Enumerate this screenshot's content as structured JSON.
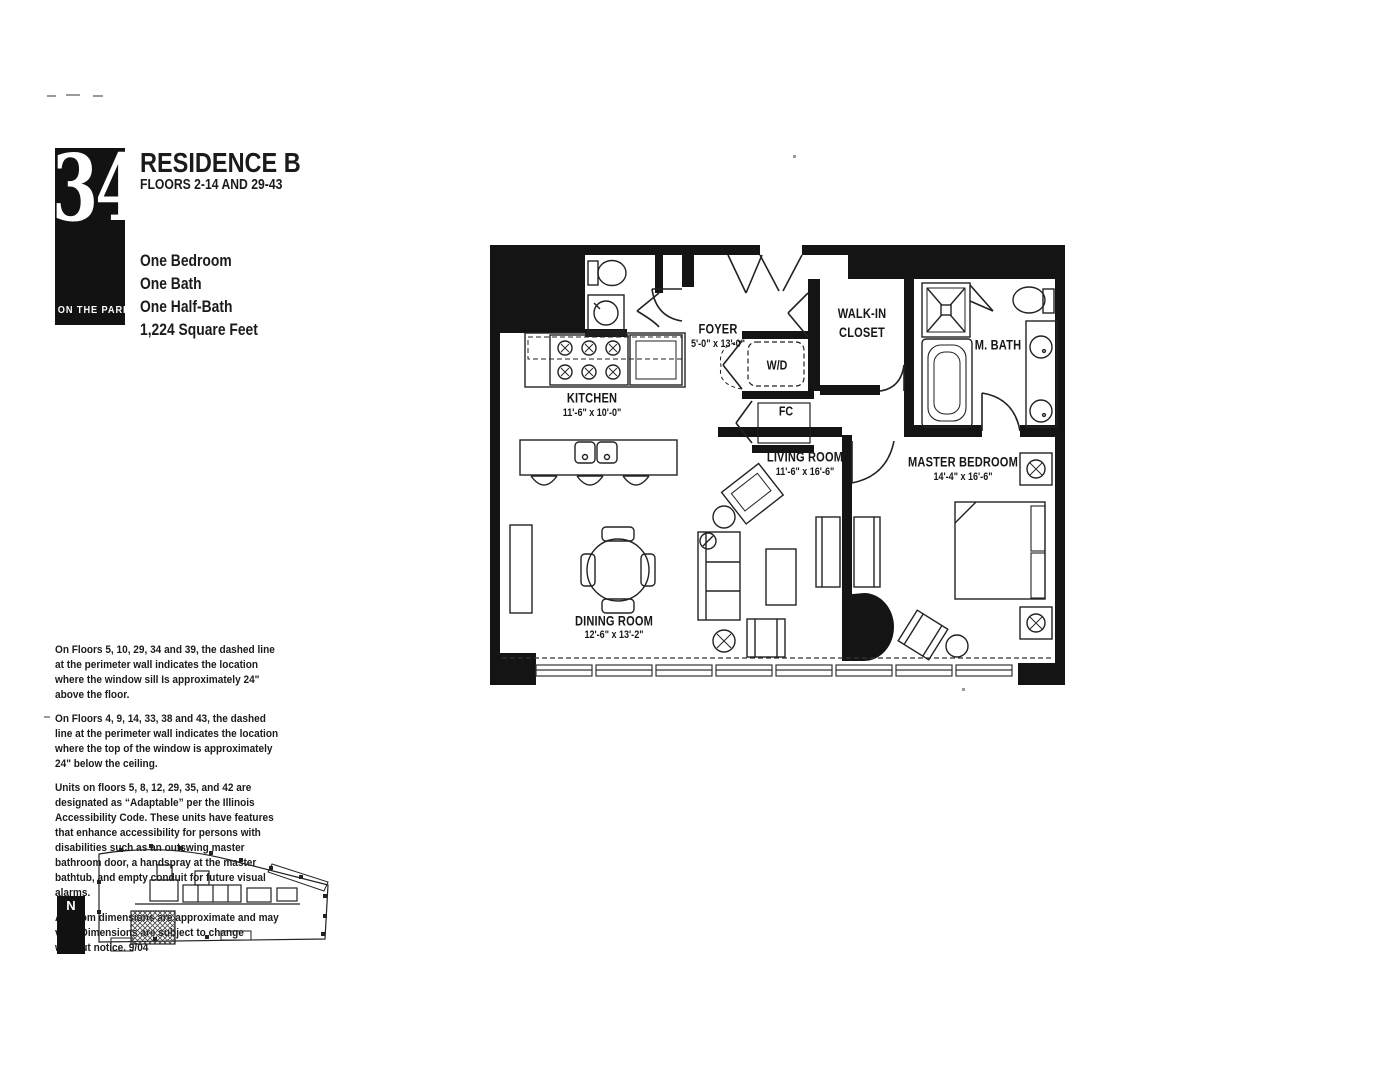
{
  "logo": {
    "number": "340",
    "tagline": "ON THE PARK"
  },
  "header": {
    "title": "RESIDENCE B",
    "subtitle": "FLOORS 2-14 AND 29-43"
  },
  "unit_facts": {
    "line1": "One Bedroom",
    "line2": "One Bath",
    "line3": "One Half-Bath",
    "line4": "1,224 Square Feet"
  },
  "floorplan": {
    "kitchen": {
      "name": "KITCHEN",
      "dims": "11'-6\" x 10'-0\""
    },
    "foyer": {
      "name": "FOYER",
      "dims": "5'-0\" x 13'-0\""
    },
    "living": {
      "name": "LIVING ROOM",
      "dims": "11'-6\" x 16'-6\""
    },
    "dining": {
      "name": "DINING ROOM",
      "dims": "12'-6\" x 13'-2\""
    },
    "master": {
      "name": "MASTER BEDROOM",
      "dims": "14'-4\" x 16'-6\""
    },
    "walkin": {
      "name": "WALK-IN CLOSET"
    },
    "mbath": {
      "name": "M. BATH"
    },
    "wd": {
      "name": "W/D"
    },
    "fc": {
      "name": "FC"
    }
  },
  "notes": {
    "p1": "On Floors 5, 10, 29, 34 and 39, the dashed line at the perimeter wall indicates the location where the window sill Is approximately 24\" above the floor.",
    "p2": "On Floors 4, 9, 14, 33, 38 and 43, the dashed line at the perimeter wall indicates the location where the top of the window is approximately 24\" below the ceiling.",
    "p3": "Units on floors 5, 8, 12, 29, 35, and 42 are designated as “Adaptable” per the Illinois Accessibility Code. These units have features that enhance accessibility for persons with disabilities such as an outswing master bathroom door, a handspray at the master bathtub, and empty conduit for future visual alarms.",
    "p4": "All room dimensions are approximate and may vary. Dimensions are subject to change without notice. 9/04"
  },
  "keyplan": {
    "north_label": "N"
  }
}
